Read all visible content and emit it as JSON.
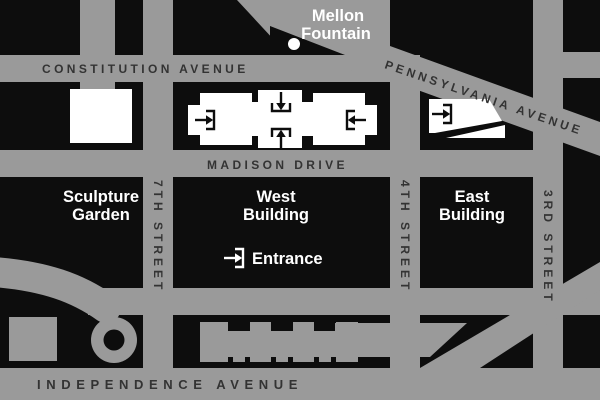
{
  "map": {
    "streets": {
      "constitution": "CONSTITUTION AVENUE",
      "pennsylvania": "PENNSYLVANIA AVENUE",
      "madison": "MADISON DRIVE",
      "independence": "INDEPENDENCE AVENUE",
      "seventh": "7TH STREET",
      "fourth": "4TH STREET",
      "third": "3RD STREET"
    },
    "labels": {
      "mellon": {
        "line1": "Mellon",
        "line2": "Fountain"
      },
      "sculpture_garden": {
        "line1": "Sculpture",
        "line2": "Garden"
      },
      "west_building": {
        "line1": "West",
        "line2": "Building"
      },
      "east_building": {
        "line1": "East",
        "line2": "Building"
      },
      "entrance": "Entrance"
    },
    "colors": {
      "road": "#9a9a9a",
      "block": "#0d0d0d",
      "gallery_building": "#ffffff",
      "other_building": "#9a9a9a",
      "street_text": "#333333",
      "place_text": "#ffffff"
    }
  }
}
